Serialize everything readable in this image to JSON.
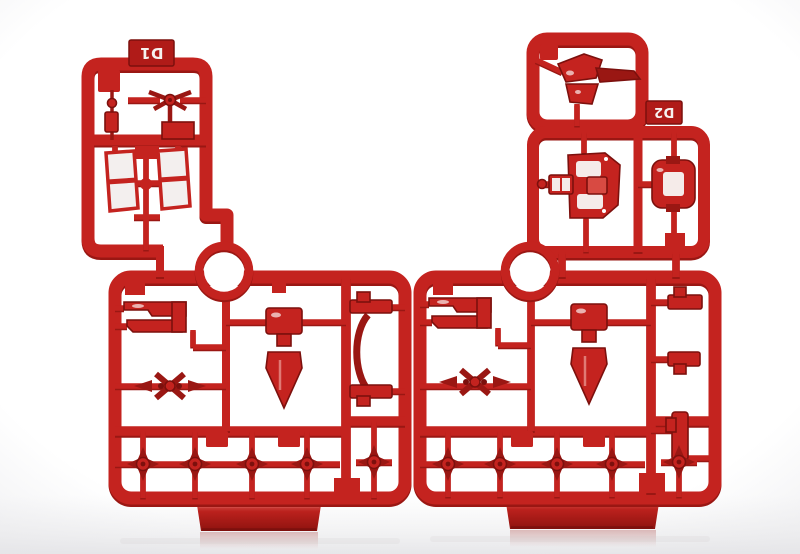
{
  "scene": {
    "description": "Two dark-red plastic model-kit part runners (sprues) standing upright side by side on a glossy white studio surface with a soft reflection below",
    "object_type": "injection-molded sprue runners",
    "surface": "seamless white backdrop"
  },
  "sprues": [
    {
      "label": "D1",
      "position": "left",
      "label_orientation": "rotated 180 degrees, white embossed text on red tab at top edge",
      "parts": [
        "rotor-joint-part",
        "pin-part",
        "glossy-panel-left",
        "glossy-panel-right",
        "ring-part",
        "forked-clamp-part",
        "cross-blade-part",
        "thruster-cone-part",
        "c-bracket-runner",
        "bracket-clamp-top",
        "bracket-clamp-bottom",
        "ball-joint-cross-1",
        "ball-joint-cross-2",
        "ball-joint-cross-3",
        "ball-joint-cross-4",
        "ball-joint-cross-5",
        "display-stand"
      ]
    },
    {
      "label": "D2",
      "position": "right",
      "label_orientation": "rotated 180 degrees, white embossed text on red tab at right edge",
      "parts": [
        "vane-part",
        "armor-shell-center",
        "clip-part",
        "armor-shell-right",
        "ring-part",
        "forked-clamp-part",
        "cross-blade-part",
        "thruster-cone-part",
        "bracket-clamp-top",
        "bracket-clamp-middle",
        "bracket-clamp-bottom",
        "ball-joint-cross-1",
        "ball-joint-cross-2",
        "ball-joint-cross-3",
        "ball-joint-cross-4",
        "ball-joint-cross-5",
        "display-stand"
      ]
    }
  ],
  "colors": {
    "red_main": "#c4231f",
    "red_dark": "#9a1713",
    "red_deep": "#7c100d",
    "red_bright": "#d84a42",
    "label_bg": "#b01b18",
    "label_text": "#f6f2f0",
    "panel_white": "#f3efee",
    "hole_white": "#f5ebe9",
    "bg": "#ffffff",
    "bg_edge": "#f1f1f3",
    "floor": "#e7e7ea",
    "reflection_red": "#c98886"
  }
}
